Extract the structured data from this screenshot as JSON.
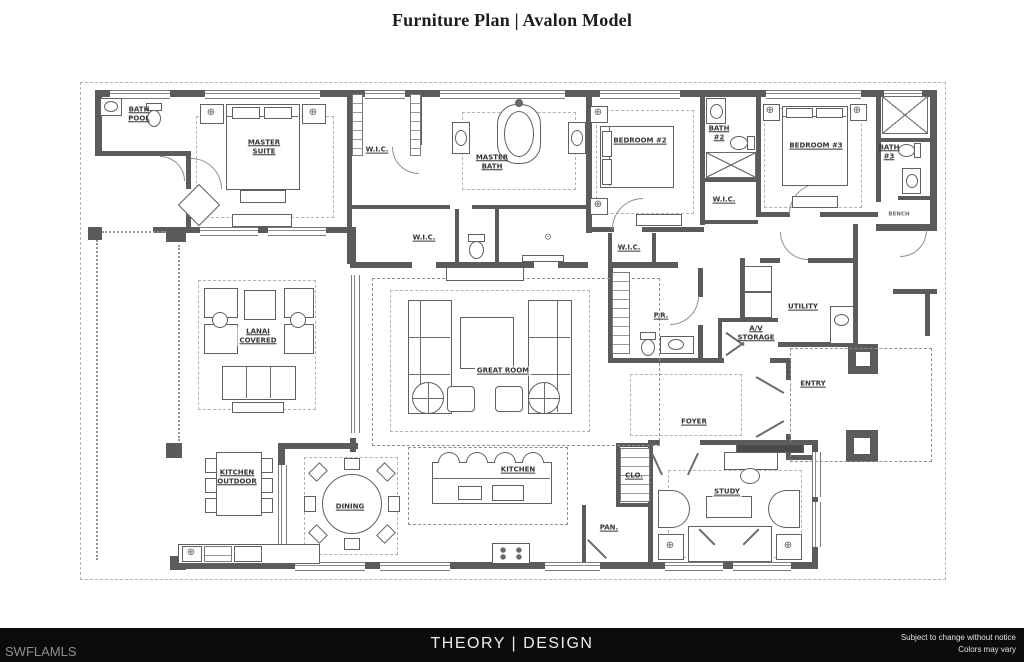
{
  "title": "Furniture Plan | Avalon Model",
  "footer": {
    "watermark": "SWFLAMLS",
    "brand": "THEORY | DESIGN",
    "disclaimer_line1": "Subject to change without notice",
    "disclaimer_line2": "Colors may vary"
  },
  "icons": {
    "lamp": "⊕",
    "ceiling_light": "⊙"
  },
  "colors": {
    "wall": "#5b5b5b",
    "line": "#606060",
    "dash": "#b3b3b3",
    "footer_bg": "#0b0b0b",
    "label": "#353535",
    "paper": "#ffffff"
  },
  "rooms": [
    {
      "id": "bath-pool",
      "label": "BATH\nPOOL"
    },
    {
      "id": "master-suite",
      "label": "MASTER\nSUITE"
    },
    {
      "id": "wic-master-top",
      "label": "W.I.C."
    },
    {
      "id": "master-bath",
      "label": "MASTER\nBATH"
    },
    {
      "id": "bedroom-2",
      "label": "BEDROOM #2"
    },
    {
      "id": "bath-2",
      "label": "BATH\n#2"
    },
    {
      "id": "wic-bedroom-2",
      "label": "W.I.C."
    },
    {
      "id": "bedroom-3",
      "label": "BEDROOM #3"
    },
    {
      "id": "bath-3",
      "label": "BATH\n#3"
    },
    {
      "id": "bench",
      "label": "BENCH"
    },
    {
      "id": "wic-master-lower",
      "label": "W.I.C."
    },
    {
      "id": "wic-hall",
      "label": "W.I.C."
    },
    {
      "id": "lanai-covered",
      "label": "LANAI\nCOVERED"
    },
    {
      "id": "great-room",
      "label": "GREAT ROOM"
    },
    {
      "id": "powder-room",
      "label": "P.R."
    },
    {
      "id": "av-storage",
      "label": "A/V\nSTORAGE"
    },
    {
      "id": "utility",
      "label": "UTILITY"
    },
    {
      "id": "entry",
      "label": "ENTRY"
    },
    {
      "id": "foyer",
      "label": "FOYER"
    },
    {
      "id": "kitchen-outdoor",
      "label": "KITCHEN\nOUTDOOR"
    },
    {
      "id": "dining",
      "label": "DINING"
    },
    {
      "id": "kitchen",
      "label": "KITCHEN"
    },
    {
      "id": "pantry",
      "label": "PAN."
    },
    {
      "id": "closet",
      "label": "CLO."
    },
    {
      "id": "study",
      "label": "STUDY"
    }
  ]
}
